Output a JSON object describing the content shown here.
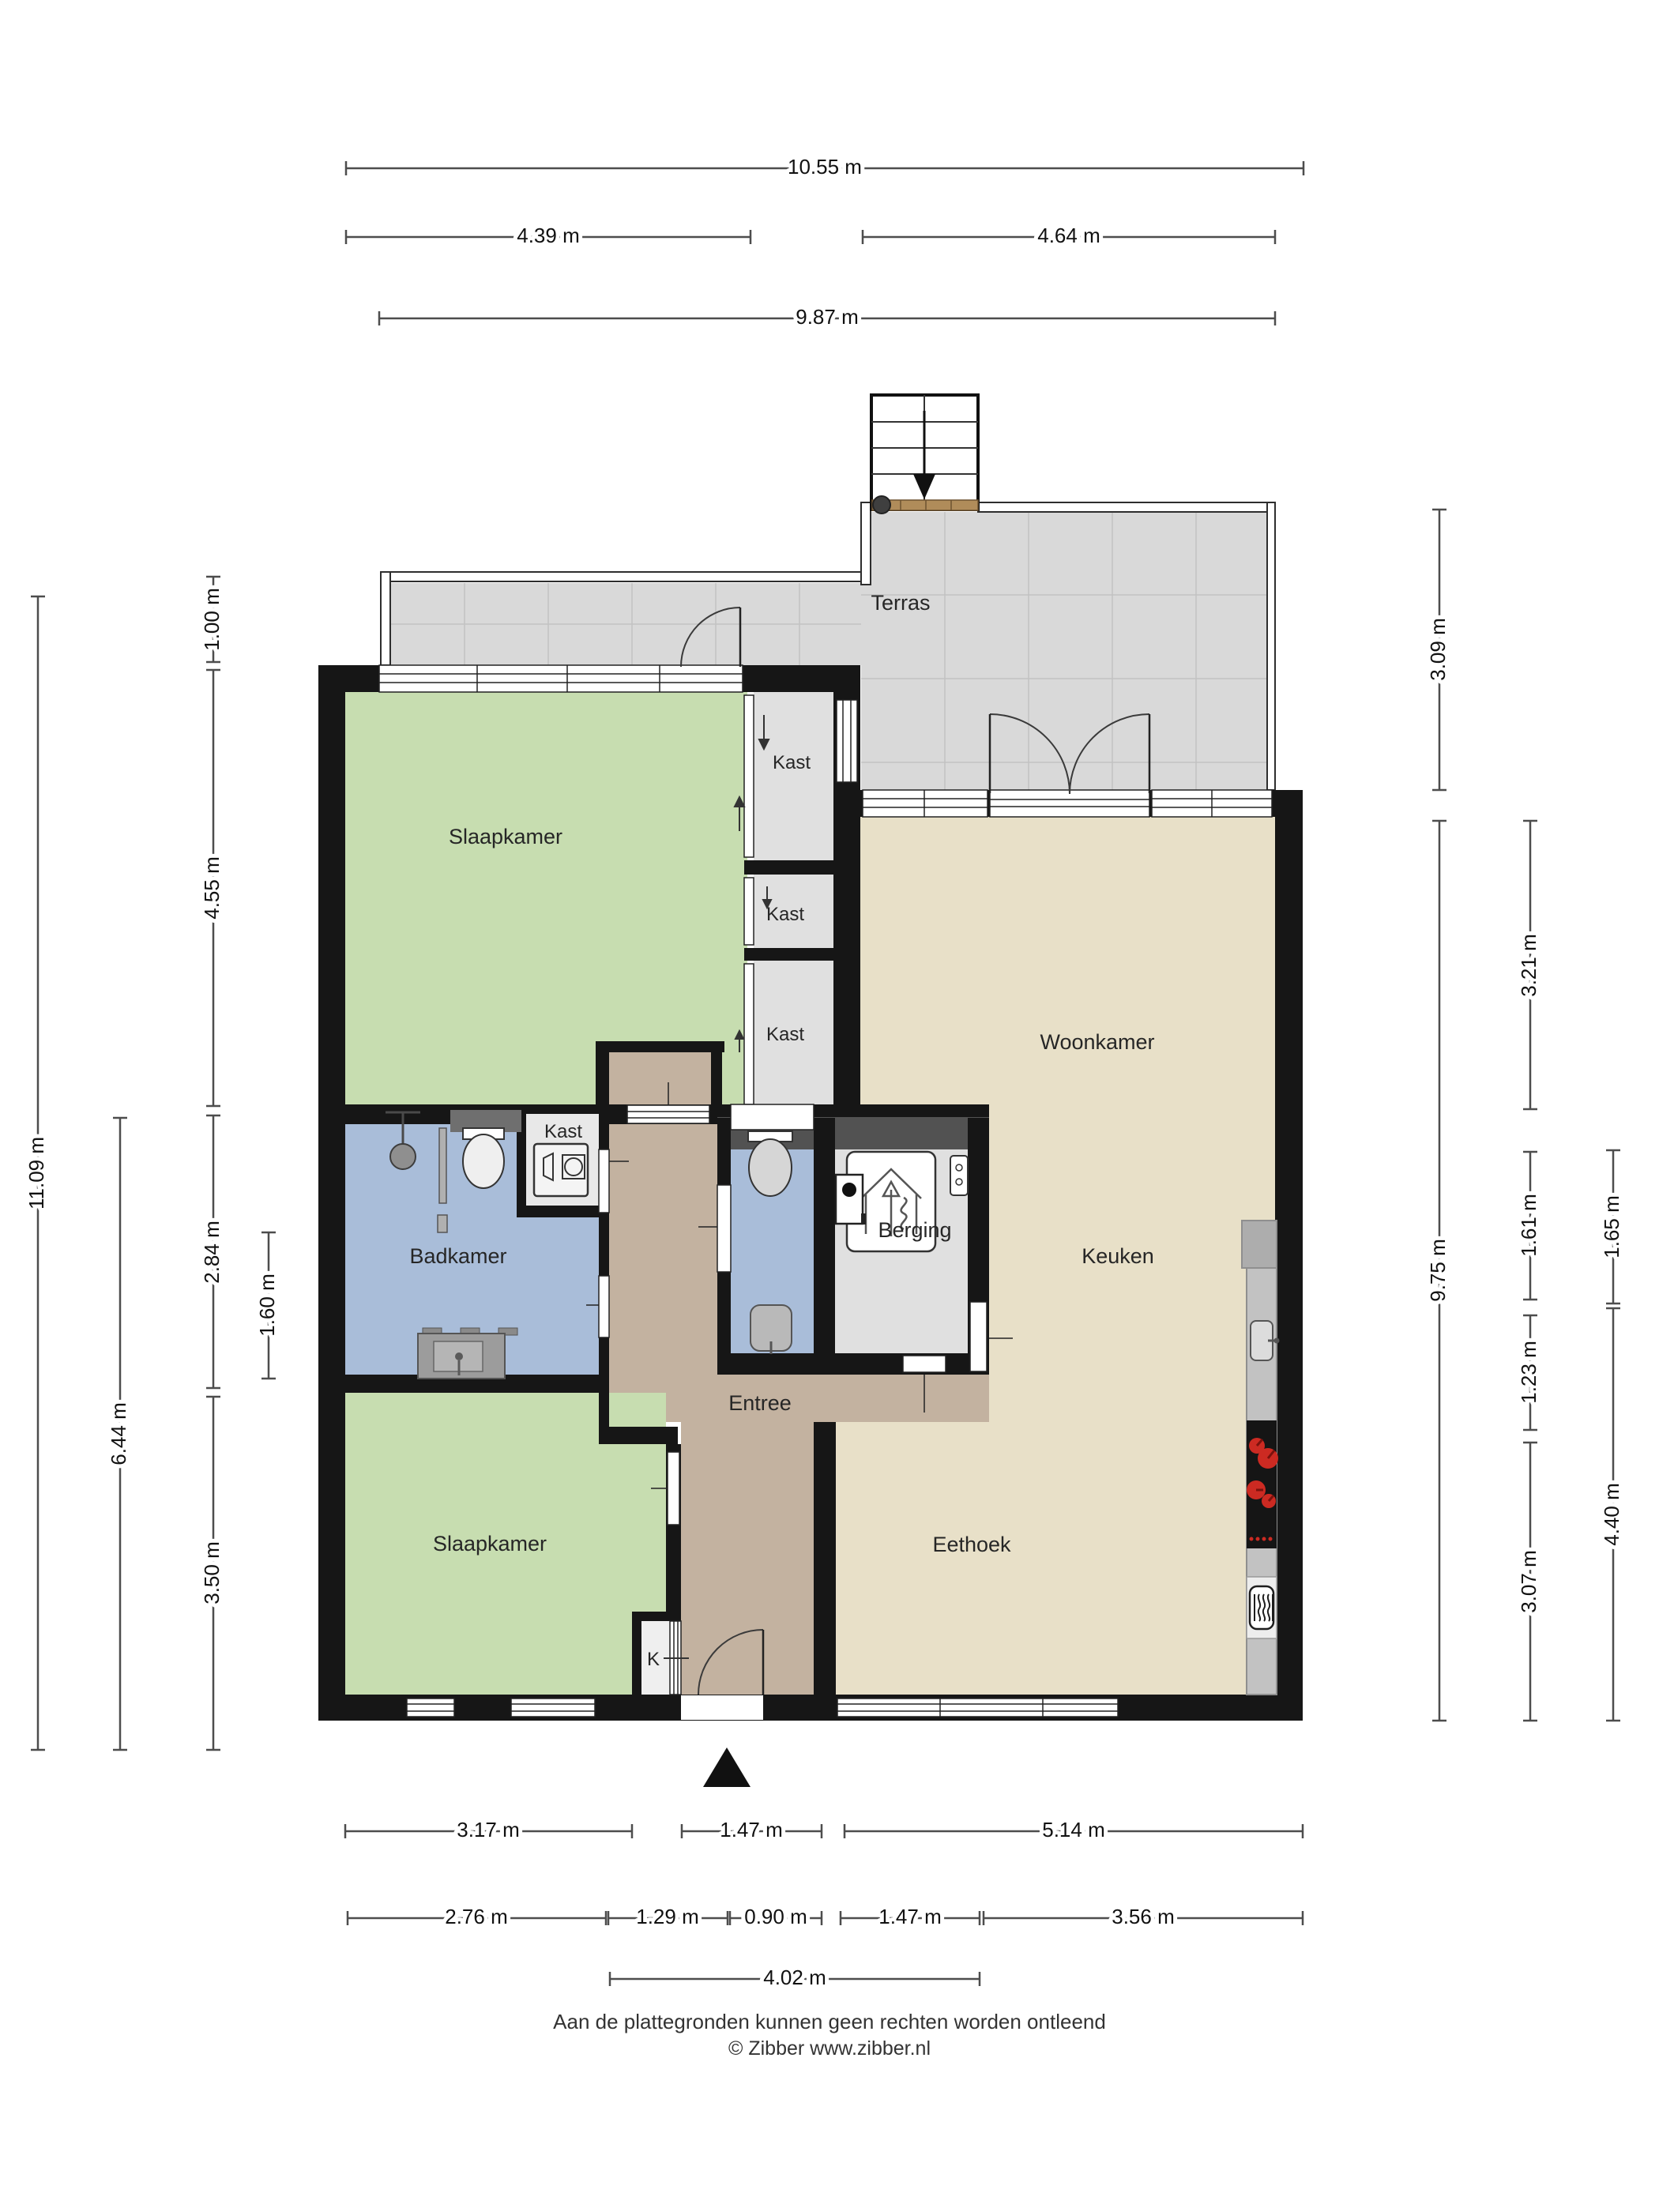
{
  "document": {
    "type": "floor-plan",
    "footer": {
      "disclaimer": "Aan de plattegronden kunnen geen rechten worden ontleend",
      "credit": "© Zibber www.zibber.nl"
    }
  },
  "rooms": {
    "terras": "Terras",
    "slaapkamer_boven": "Slaapkamer",
    "slaapkamer_onder": "Slaapkamer",
    "kast_1": "Kast",
    "kast_2": "Kast",
    "kast_3": "Kast",
    "kast_badkamer": "Kast",
    "woonkamer": "Woonkamer",
    "badkamer": "Badkamer",
    "berging": "Berging",
    "entree": "Entree",
    "keuken": "Keuken",
    "eethoek": "Eethoek",
    "k_closet": "K"
  },
  "dimensions": {
    "top": [
      "10.55 m",
      "4.39 m",
      "4.64 m",
      "9.87 m"
    ],
    "left": [
      "11.09 m",
      "6.44 m",
      "1.00 m",
      "4.55 m",
      "2.84 m",
      "3.50 m",
      "1.60 m"
    ],
    "right": [
      "3.09 m",
      "9.75 m",
      "3.21 m",
      "1.61 m",
      "1.23 m",
      "3.07 m",
      "1.65 m",
      "4.40 m"
    ],
    "bottom": [
      "3.17 m",
      "1.47 m",
      "5.14 m",
      "2.76 m",
      "1.29 m",
      "0.90 m",
      "1.47 m",
      "3.56 m",
      "4.02 m"
    ]
  },
  "icons": {
    "stairs": "stairs-icon",
    "north": "north-arrow-icon",
    "shower": "shower-icon",
    "toilet_bath": "toilet-icon",
    "toilet_wc": "toilet-icon",
    "washbasin": "washbasin-icon",
    "hand_basin": "hand-basin-icon",
    "washing_machine": "washing-machine-icon",
    "ventilation": "ventilation-unit-icon",
    "boiler": "boiler-icon",
    "intercom": "intercom-icon",
    "kitchen_sink": "kitchen-sink-icon",
    "cooktop": "cooktop-icon",
    "microwave": "microwave-icon"
  },
  "colors": {
    "wall": "#161616",
    "terrace": "#d9d9d9",
    "bedroom": "#c7ddb0",
    "living": "#e8e0c8",
    "bathroom": "#a9bdd9",
    "hallway": "#c3b2a0",
    "storage": "#e0e0e0",
    "burner_red": "#cc2a22",
    "wood": "#b08c5a"
  }
}
